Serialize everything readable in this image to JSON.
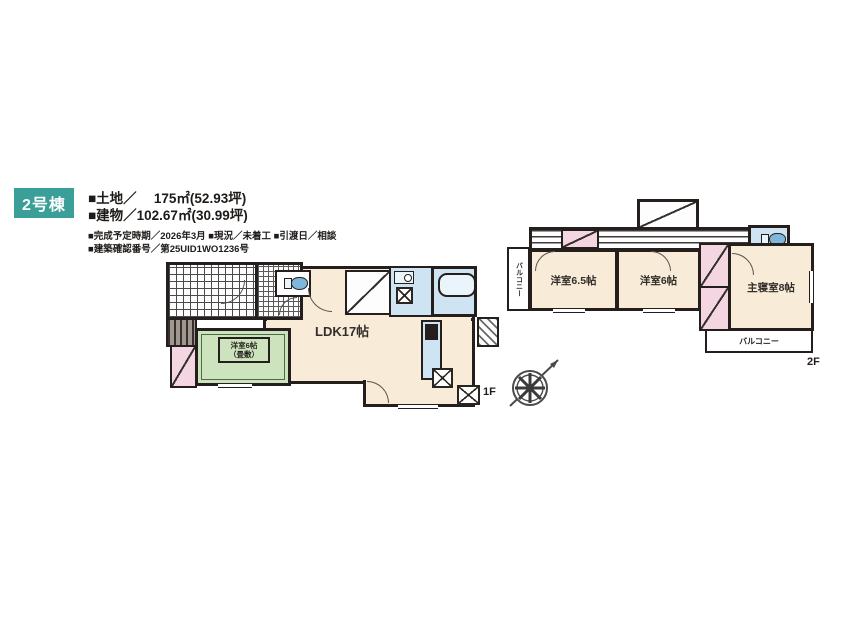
{
  "header": {
    "badge": "2号棟",
    "land_label": "■土地／　 175㎡(52.93坪)",
    "building_label": "■建物／102.67㎡(30.99坪)",
    "info_line1": "■完成予定時期／2026年3月 ■現況／未着工 ■引渡日／相談",
    "info_line2": "■建築確認番号／第25UID1WO1236号"
  },
  "floor1": {
    "floor_label": "1F",
    "ldk_label": "LDK17帖",
    "western_room_line1": "洋室6帖",
    "western_room_line2": "（畳敷）"
  },
  "floor2": {
    "floor_label": "2F",
    "room_left_label": "洋室6.5帖",
    "room_middle_label": "洋室6帖",
    "master_bedroom_label": "主寝室8帖",
    "balcony_left_label": "バルコニー",
    "balcony_bottom_label": "バルコニー"
  },
  "colors": {
    "badge_teal": "#3a9e99",
    "room_cream": "#f8ecd8",
    "tatami_green": "#cde3bd",
    "wet_area_blue": "#cfe4f2",
    "closet_pink": "#f4d6e2",
    "wall": "#241f1c"
  }
}
